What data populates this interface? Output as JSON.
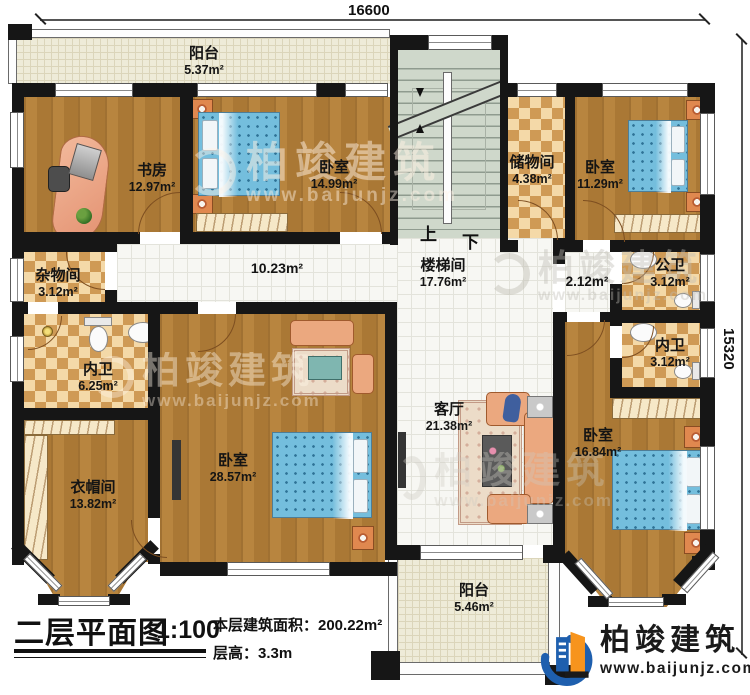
{
  "dimensions": {
    "top": "16600",
    "right": "15320"
  },
  "stairs": {
    "up": "上",
    "down": "下"
  },
  "rooms": [
    {
      "name": "阳台",
      "area": "5.37m²"
    },
    {
      "name": "书房",
      "area": "12.97m²"
    },
    {
      "name": "卧室",
      "area": "14.99m²"
    },
    {
      "name": "储物间",
      "area": "4.38m²"
    },
    {
      "name": "卧室",
      "area": "11.29m²"
    },
    {
      "name": "楼梯间",
      "area": "17.76m²"
    },
    {
      "name": "杂物间",
      "area": "3.12m²"
    },
    {
      "name": "",
      "area": "10.23m²"
    },
    {
      "name": "",
      "area": "2.12m²"
    },
    {
      "name": "公卫",
      "area": "3.12m²"
    },
    {
      "name": "内卫",
      "area": "3.12m²"
    },
    {
      "name": "内卫",
      "area": "6.25m²"
    },
    {
      "name": "衣帽间",
      "area": "13.82m²"
    },
    {
      "name": "卧室",
      "area": "28.57m²"
    },
    {
      "name": "客厅",
      "area": "21.38m²"
    },
    {
      "name": "卧室",
      "area": "16.84m²"
    },
    {
      "name": "阳台",
      "area": "5.46m²"
    }
  ],
  "title": {
    "main": "二层平面图",
    "scale": "1:100",
    "floor_area": "本层建筑面积：200.22m²",
    "floor_height": "层高：3.3m"
  },
  "logo": {
    "name": "柏竣建筑",
    "url": "www.baijunjz.com"
  },
  "watermark": {
    "name": "柏竣建筑",
    "url": "www.baijunjz.com"
  },
  "colors": {
    "wall": "#161616",
    "wood": "#b5823f",
    "checker": "#cf9a55",
    "tile": "#f7f7f3",
    "balcony": "#eeebd8",
    "stair": "#cfd8cb",
    "bed": "#74bedd",
    "logo_blue": "#1e5fae",
    "logo_orange": "#f7941d"
  }
}
